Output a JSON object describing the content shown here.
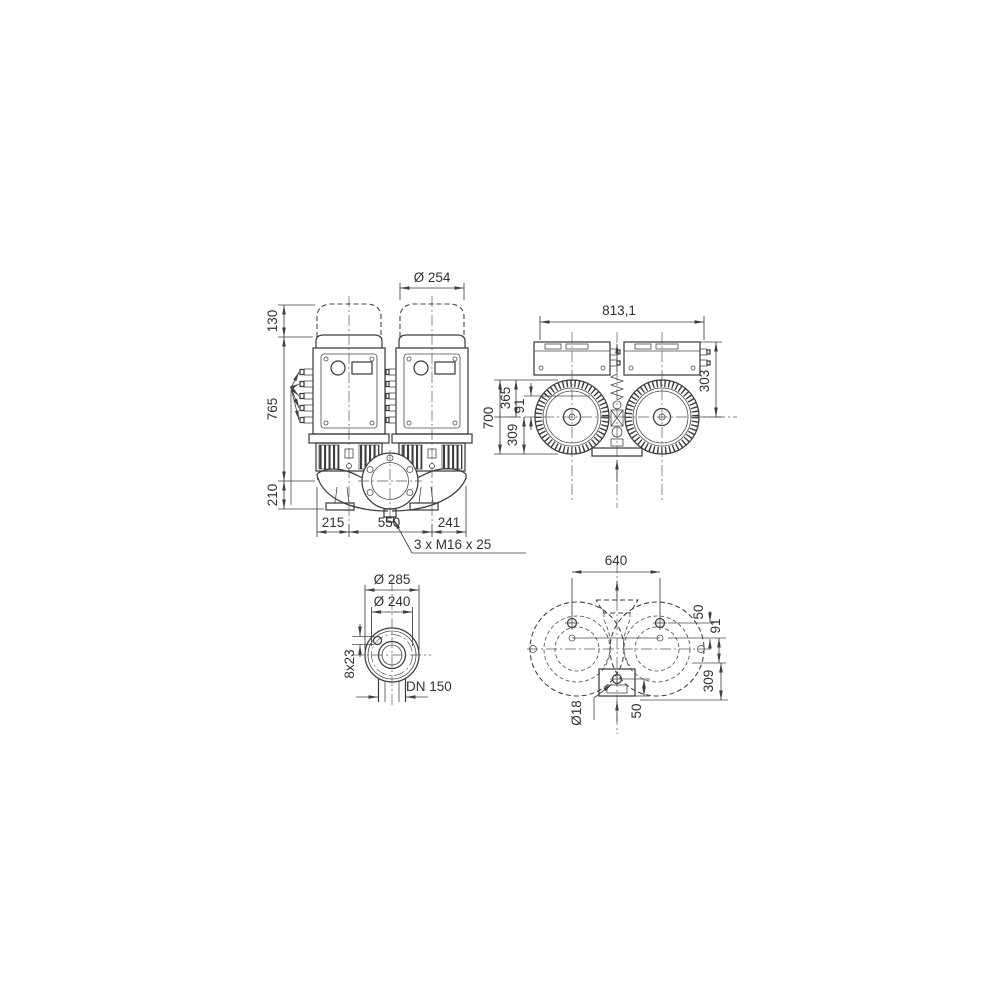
{
  "title": "Twin-head inline pump dimensional drawing",
  "colors": {
    "background": "#ffffff",
    "line": "#3d3d3d",
    "dimension": "#3f3f3f",
    "text": "#323232"
  },
  "front_view": {
    "motor_hood_diameter": "Ø 254",
    "hood_extra_height": "130",
    "height_above_pipe_axis": "765",
    "height_below_pipe_axis": "210",
    "left_edge_to_first_axis": "215",
    "pump_head_spacing": "550",
    "second_axis_to_right_edge": "241",
    "foundation_bolt_note": "3 x M16 x 25"
  },
  "motor_plan_view": {
    "overall_width": "813,1",
    "overall_depth": "700",
    "front_edge_to_motor_axis": "365",
    "pipe_axis_to_motor_axis": "91",
    "motor_axis_to_rear_edge": "309",
    "terminal_box_to_motor_axis": "303"
  },
  "flange_detail_view": {
    "flange_outer_diameter": "Ø 285",
    "bolt_circle_diameter": "Ø 240",
    "bolt_holes_count_size": "8x23",
    "nominal_diameter": "DN 150"
  },
  "casing_plan_view": {
    "foot_hole_spacing": "640",
    "foot_hole_pair_offset": "50",
    "pipe_axis_to_foot_axis": "91",
    "pipe_axis_to_rear_edge": "309",
    "foot_hole_diameter": "Ø18",
    "bottom_hole_to_edge": "50"
  }
}
